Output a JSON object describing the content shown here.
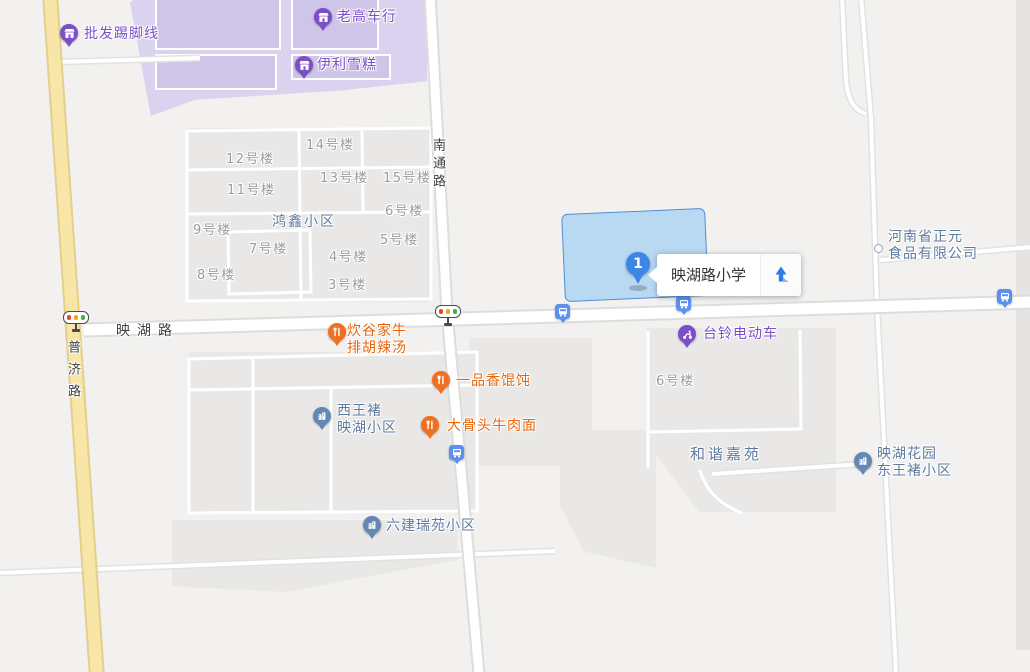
{
  "selected": {
    "name": "映湖路小学",
    "marker_number": "1",
    "directions_icon": "navigate-arrow-icon"
  },
  "roads": {
    "yinghu_lu": "映湖路",
    "nantong_lu": "南通路",
    "puji_lu": "普济路"
  },
  "districts": {
    "hongxin": "鸿鑫小区",
    "hexie": "和谐嘉苑"
  },
  "buildings": {
    "b14": "14号楼",
    "b12": "12号楼",
    "b13": "13号楼",
    "b15": "15号楼",
    "b11": "11号楼",
    "b6": "6号楼",
    "b9": "9号楼",
    "b5": "5号楼",
    "b7": "7号楼",
    "b4": "4号楼",
    "b8": "8号楼",
    "b3": "3号楼",
    "b6_hexie": "6号楼"
  },
  "pois": {
    "pifa_tijiaoxian": {
      "label": "批发踢脚线",
      "category": "shop"
    },
    "laogao_chehang": {
      "label": "老高车行",
      "category": "shop"
    },
    "yili_xuegao": {
      "label": "伊利雪糕",
      "category": "shop"
    },
    "chuigujia": {
      "line1": "炊谷家牛",
      "line2": "排胡辣汤",
      "category": "food"
    },
    "yipinxiang_huntun": {
      "label": "一品香馄饨",
      "category": "food"
    },
    "dagutou_niuroumian": {
      "label": "大骨头牛肉面",
      "category": "food"
    },
    "tailing_diandongche": {
      "label": "台铃电动车",
      "category": "shop"
    },
    "xiwangchu_yinghu": {
      "line1": "西王褚",
      "line2": "映湖小区",
      "category": "residence"
    },
    "zhengyuan_shipin": {
      "line1": "河南省正元",
      "line2": "食品有限公司",
      "category": "company"
    },
    "yinghu_huayuan": {
      "line1": "映湖花园",
      "line2": "东王褚小区",
      "category": "residence"
    },
    "liujian_ruiyuan": {
      "label": "六建瑞苑小区",
      "category": "residence"
    }
  },
  "colors": {
    "poi_shop_purple": "#7b4fc8",
    "poi_food_orange": "#e8650a",
    "poi_residence_blue": "#5e7a9f",
    "road_yellow_fill": "#f7e6a8",
    "purple_area_fill": "#dad2ee",
    "selected_building_fill": "#b9d9f3",
    "selected_building_border": "#4f8fd4",
    "selected_marker_blue": "#3c86e6",
    "bus_stop_blue": "#5b8ff0"
  }
}
